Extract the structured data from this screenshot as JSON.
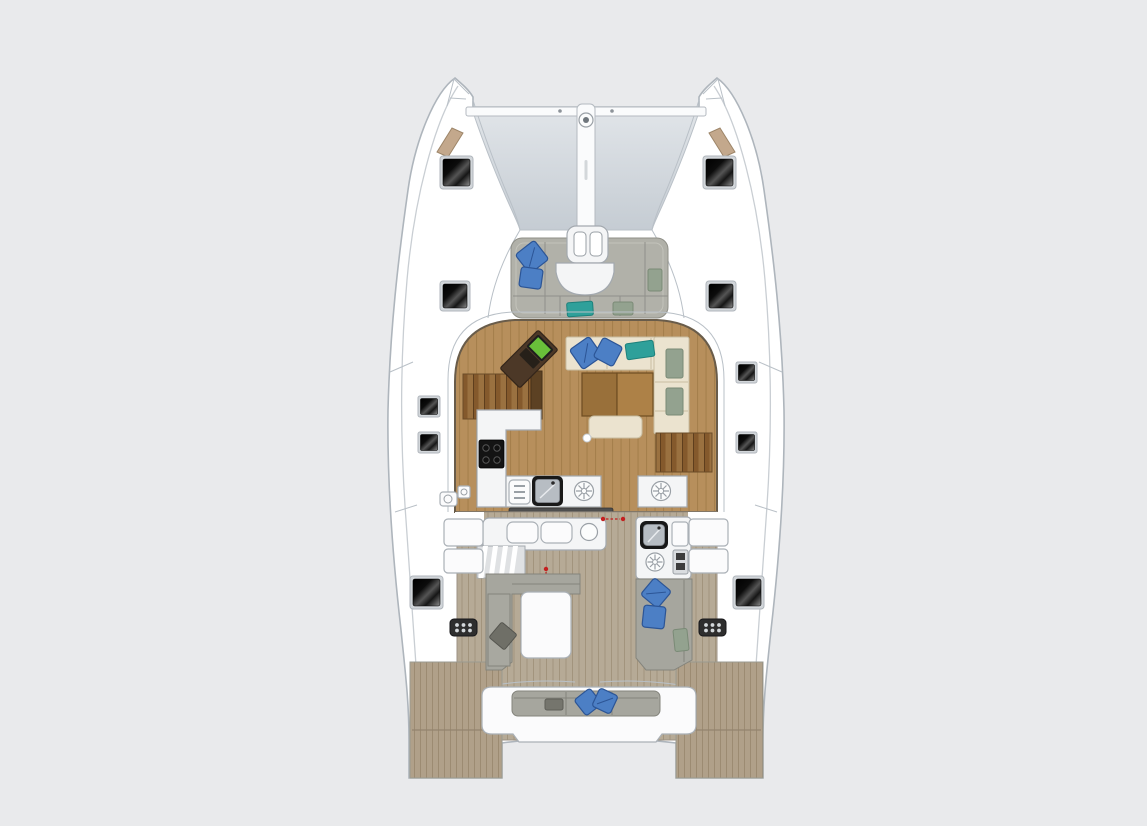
{
  "title": "Catamaran deck and saloon floor plan (top view)",
  "diagram_type": "boat-floor-plan",
  "colors": {
    "background": "#e9eaec",
    "hull_white": "#ffffff",
    "hull_outline": "#aeb5bc",
    "detail_line": "#c9ced3",
    "trampoline_top": "#e0e4e8",
    "trampoline_bottom": "#c5ccd3",
    "hatch_black": "#0a0a0a",
    "hatch_sheen": "#8f8f8f",
    "hatch_frame": "#d2d6da",
    "bow_vent_tan": "#c3a88c",
    "salon_wood": "#b78f5c",
    "salon_wood_line": "#a57f4c",
    "stair_wood_dark": "#84592c",
    "stair_wood_light": "#9a7140",
    "nav_desk_brown": "#4c3827",
    "laptop_screen_green": "#69bf3a",
    "sofa_cream": "#ebe3cf",
    "sofa_seam": "#c8bea2",
    "headrest_green": "#93a28f",
    "table_wood_dark": "#99703a",
    "table_wood_light": "#ad8147",
    "counter_white": "#f4f5f6",
    "counter_outline": "#a3a9af",
    "cooktop_black": "#141414",
    "sink_basin_gray": "#b7bdc3",
    "cockpit_teak": "#b6aa96",
    "cockpit_teak_line": "#a2947d",
    "transom_teak": "#b0a089",
    "cushion_gray": "#a6a69e",
    "cushion_gray_dark": "#8a8a82",
    "forward_cushion_gray": "#b1b1a9",
    "pillow_blue": "#4c7fc5",
    "pillow_blue_edge": "#2c5596",
    "pillow_teal": "#2fa09a",
    "door_marker_red": "#c41f1f",
    "vent_grid_dark": "#2e2e2e"
  },
  "parts": [
    "port-bow",
    "starboard-bow",
    "bow-trampoline",
    "anchor-roller-fitting",
    "forward-crossbeam",
    "forward-cockpit-lounge",
    "forward-saloon-door",
    "deck-hatches",
    "bow-deck-vents",
    "saloon",
    "navigation-desk",
    "laptop",
    "galley-l-counter",
    "cooktop",
    "galley-sink",
    "dinette-sofa",
    "dinette-table",
    "port-companionway-stairs",
    "starboard-companionway-stairs",
    "sliding-door-sill",
    "cockpit",
    "wet-bar",
    "side-boarding-steps",
    "outdoor-galley",
    "port-cockpit-sofa",
    "cockpit-table",
    "starboard-cockpit-sofa",
    "aft-bench",
    "transom-vent-grilles",
    "port-swim-platform",
    "starboard-swim-platform"
  ],
  "counts": {
    "large_deck_hatches": 6,
    "small_deck_hatches": 4,
    "blue_pillows": 8,
    "teal_pillows": 2,
    "round_deck_vents": 4,
    "vent_grilles": 2
  }
}
